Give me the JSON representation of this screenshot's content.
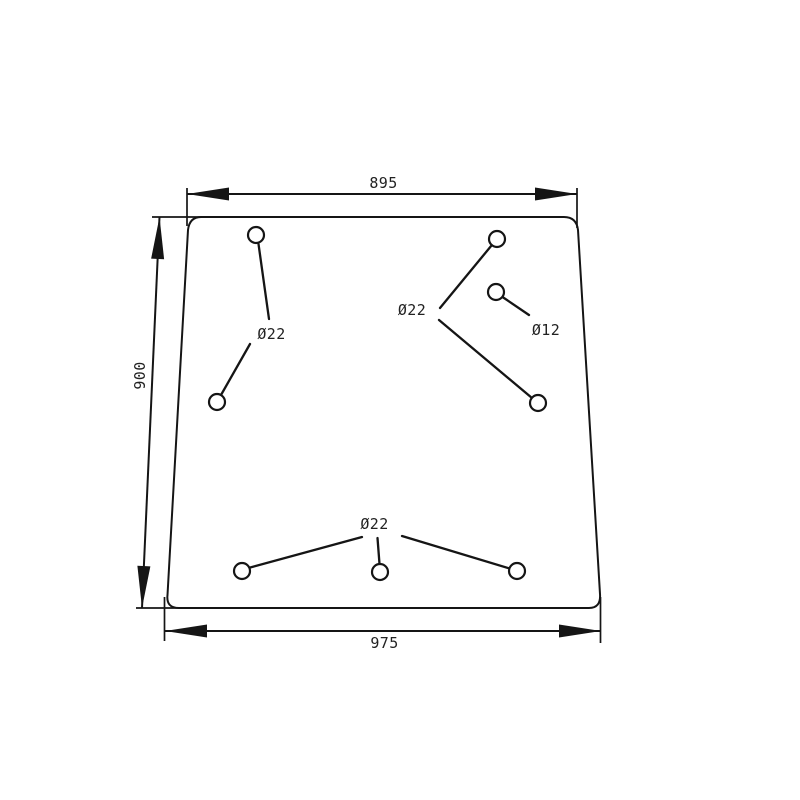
{
  "canvas": {
    "width": 800,
    "height": 800,
    "background": "#ffffff",
    "line_color": "#151515",
    "text_color": "#222222"
  },
  "panel": {
    "kind": "trapezoid-glass-panel-outline",
    "path": "M 201 217 L 564 217 Q 576.5 217 578 230 L 600 594 Q 601 608 589 608 L 179 608 Q 166 608 167.5 595 L 188 230 Q 189.5 217 201 217 Z",
    "stroke_width": 2
  },
  "arrow": {
    "length": 42,
    "half_width": 6.5
  },
  "dimensions": [
    {
      "id": "top-width",
      "label": "895",
      "line": {
        "x1": 187,
        "y1": 194,
        "x2": 577,
        "y2": 194
      },
      "extensions": [
        {
          "x1": 187,
          "y1": 188,
          "x2": 187,
          "y2": 226
        },
        {
          "x1": 577,
          "y1": 188,
          "x2": 577,
          "y2": 228
        }
      ],
      "label_pos": {
        "x": 383.5,
        "y": 188
      },
      "label_rotation": 0
    },
    {
      "id": "left-height",
      "label": "900",
      "line": {
        "x1": 159.5,
        "y1": 217,
        "x2": 142,
        "y2": 608
      },
      "extensions": [
        {
          "x1": 152,
          "y1": 217,
          "x2": 202,
          "y2": 217
        },
        {
          "x1": 136,
          "y1": 608,
          "x2": 182,
          "y2": 608
        }
      ],
      "label_pos": {
        "x": 145,
        "y": 375.5
      },
      "label_rotation": -90
    },
    {
      "id": "bottom-width",
      "label": "975",
      "line": {
        "x1": 165,
        "y1": 631,
        "x2": 601,
        "y2": 631
      },
      "extensions": [
        {
          "x1": 164.5,
          "y1": 597,
          "x2": 164.5,
          "y2": 641
        },
        {
          "x1": 600.5,
          "y1": 597,
          "x2": 600.5,
          "y2": 643
        }
      ],
      "label_pos": {
        "x": 384.5,
        "y": 648
      },
      "label_rotation": 0
    }
  ],
  "holes": [
    {
      "cx": 256,
      "cy": 235,
      "r": 8
    },
    {
      "cx": 217,
      "cy": 402,
      "r": 8
    },
    {
      "cx": 497,
      "cy": 239,
      "r": 8
    },
    {
      "cx": 496,
      "cy": 292,
      "r": 8
    },
    {
      "cx": 538,
      "cy": 403,
      "r": 8
    },
    {
      "cx": 242,
      "cy": 571,
      "r": 8
    },
    {
      "cx": 380,
      "cy": 572,
      "r": 8
    },
    {
      "cx": 517,
      "cy": 571,
      "r": 8
    }
  ],
  "leaders": [
    {
      "x1": 258.5,
      "y1": 244,
      "x2": 269,
      "y2": 319
    },
    {
      "x1": 250,
      "y1": 344,
      "x2": 221,
      "y2": 395
    },
    {
      "x1": 440,
      "y1": 308,
      "x2": 491.5,
      "y2": 245.5
    },
    {
      "x1": 439,
      "y1": 320,
      "x2": 532,
      "y2": 398
    },
    {
      "x1": 502.5,
      "y1": 297,
      "x2": 529,
      "y2": 315
    },
    {
      "x1": 362,
      "y1": 537,
      "x2": 246.5,
      "y2": 568.5
    },
    {
      "x1": 377.5,
      "y1": 538,
      "x2": 379.5,
      "y2": 564
    },
    {
      "x1": 402,
      "y1": 536,
      "x2": 509.5,
      "y2": 568.5
    }
  ],
  "hole_labels": [
    {
      "text": "Ø22",
      "x": 271.5,
      "y": 339
    },
    {
      "text": "Ø22",
      "x": 412,
      "y": 315
    },
    {
      "text": "Ø12",
      "x": 546,
      "y": 335
    },
    {
      "text": "Ø22",
      "x": 374.5,
      "y": 529
    }
  ]
}
